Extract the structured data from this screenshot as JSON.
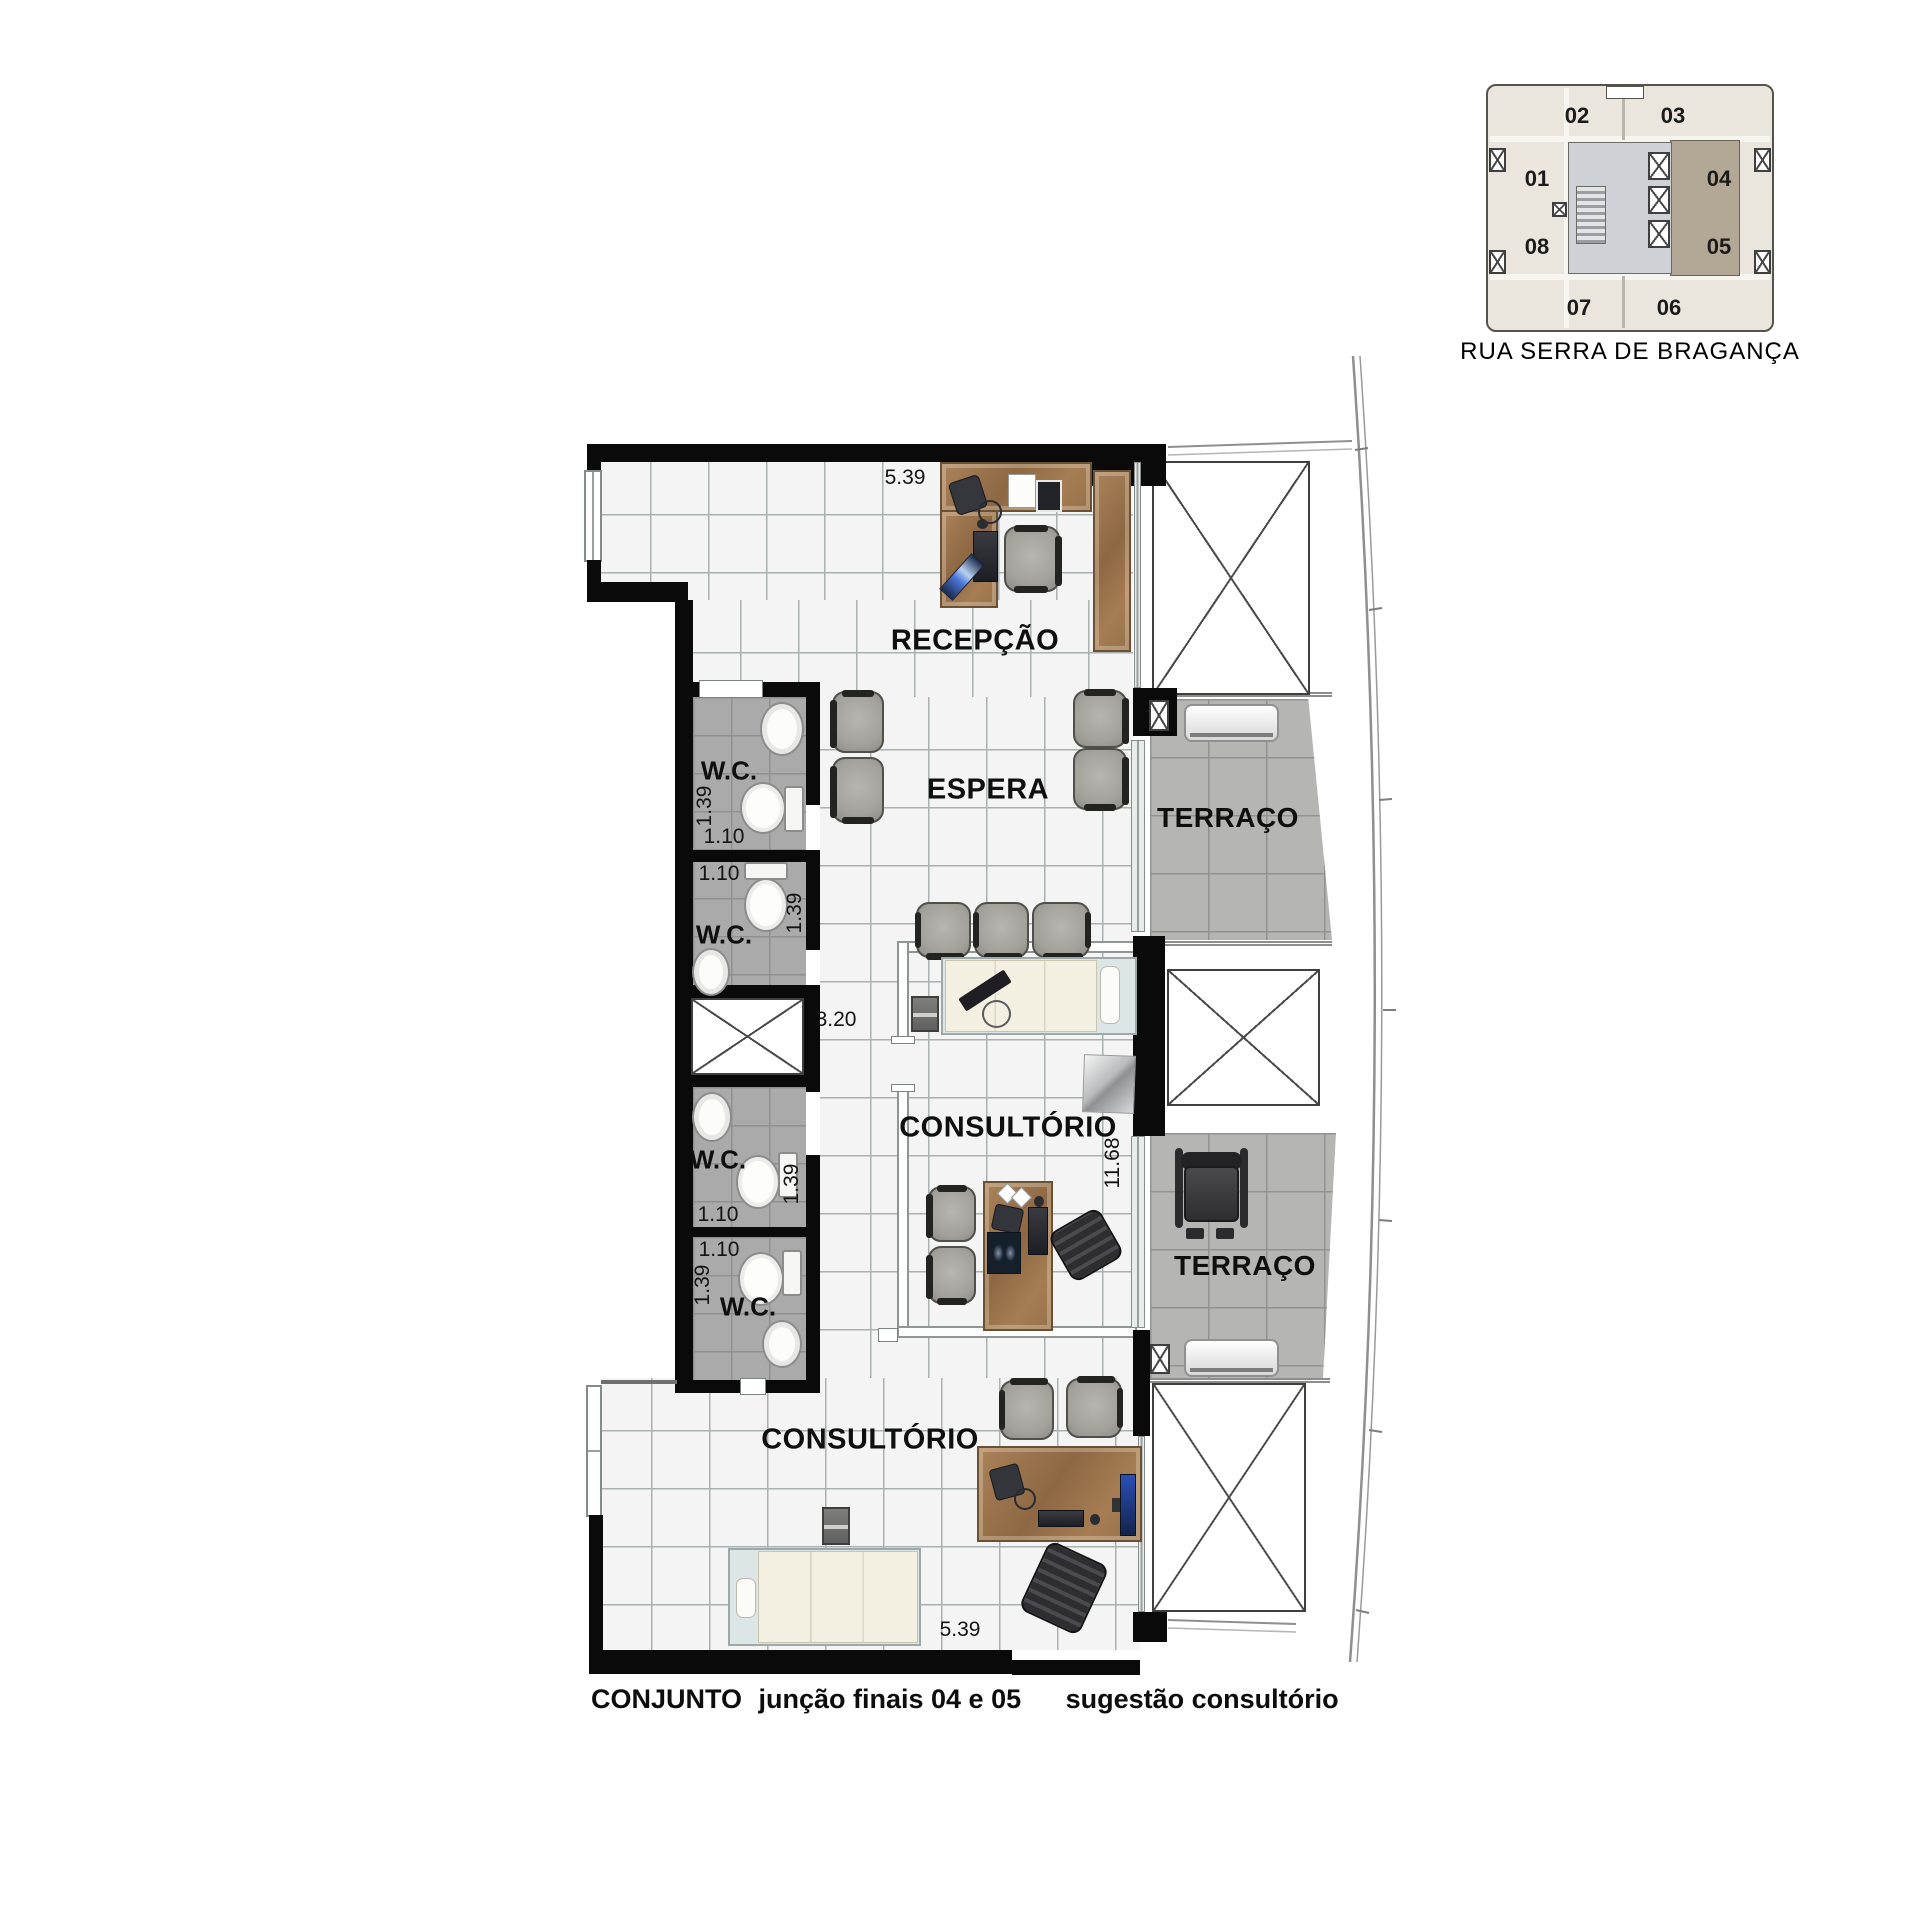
{
  "plan": {
    "rooms": {
      "recepcao": "RECEPÇÃO",
      "espera": "ESPERA",
      "consultorio_central": "CONSULTÓRIO",
      "consultorio_inferior": "CONSULTÓRIO",
      "terraco_superior": "TERRAÇO",
      "terraco_inferior": "TERRAÇO",
      "wc_1": "W.C.",
      "wc_2": "W.C.",
      "wc_3": "W.C.",
      "wc_4": "W.C."
    },
    "dimensions": {
      "largura_topo": "5.39",
      "largura_base": "5.39",
      "profundidade": "11.68",
      "hall": "3.20",
      "wc1_frente": "1.39",
      "wc1_fundo": "1.10",
      "wc2_fundo": "1.10",
      "wc2_frente": "1.39",
      "wc3_frente": "1.39",
      "wc3_fundo": "1.10",
      "wc4_fundo": "1.10",
      "wc4_frente": "1.39"
    }
  },
  "key_plan": {
    "street": "RUA SERRA DE BRAGANÇA",
    "units": [
      {
        "label": "01"
      },
      {
        "label": "02"
      },
      {
        "label": "03"
      },
      {
        "label": "04"
      },
      {
        "label": "05"
      },
      {
        "label": "06"
      },
      {
        "label": "07"
      },
      {
        "label": "08"
      }
    ],
    "highlighted_units": "04 e 05"
  },
  "caption": {
    "titulo": "CONJUNTO",
    "descricao": "junção finais 04 e 05",
    "sugestao": "sugestão consultório"
  },
  "colors": {
    "wall": "#0a0a0a",
    "highlight_unit": "#b3a795",
    "floor": "#f3f4f3",
    "terrace_floor": "#b5b6b4",
    "wood": "#9a7650"
  }
}
